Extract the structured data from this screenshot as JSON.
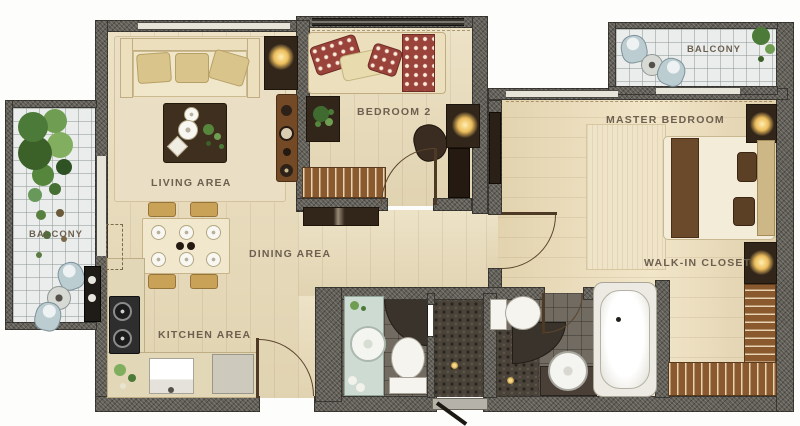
{
  "floorplan": {
    "labels": {
      "living": "LIVING AREA",
      "dining": "DINING AREA",
      "kitchen": "KITCHEN AREA",
      "bedroom2": "BEDROOM 2",
      "master_bedroom": "MASTER BEDROOM",
      "walk_in_closet": "WALK-IN CLOSET",
      "balcony_left": "BALCONY",
      "balcony_top_right": "BALCONY"
    },
    "colors": {
      "wall_granite": "#615e57",
      "wood_floor": "#e9dcba",
      "master_wood_floor": "#eedfba",
      "balcony_tile": "#eaedeb",
      "bathroom_tile": "#716b62",
      "dark_mosaic": "#4a433a",
      "label_text": "#6d6050",
      "bed_red_accent": "#9a433a",
      "furniture_brown": "#744a26",
      "dark_furniture": "#32261b",
      "fixture_white": "#f5f4ee",
      "lamp_glow": "#f2cf7e",
      "plant_green": "#4c7a38",
      "balcony_chair": "#bccdd2",
      "mint_counter": "#cedbd2"
    }
  }
}
